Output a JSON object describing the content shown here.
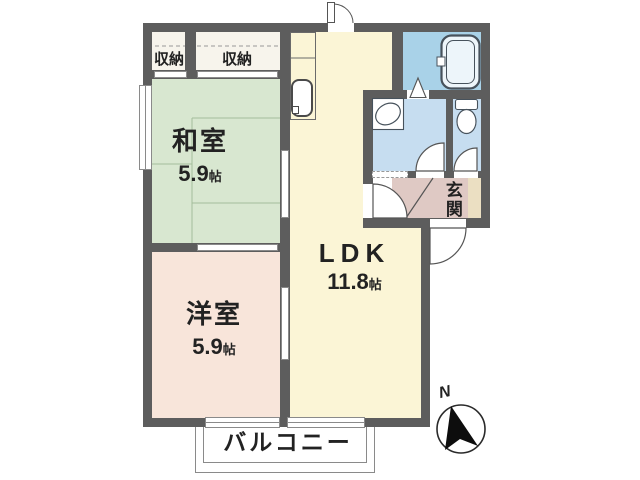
{
  "floor_plan": {
    "rooms": {
      "closet_left": {
        "label": "収納"
      },
      "closet_right": {
        "label": "収納"
      },
      "japanese_room": {
        "label": "和室",
        "area": "5.9",
        "unit": "帖"
      },
      "western_room": {
        "label": "洋室",
        "area": "5.9",
        "unit": "帖"
      },
      "ldk": {
        "label": "LDK",
        "area": "11.8",
        "unit": "帖"
      },
      "entrance": {
        "label": "玄関"
      },
      "balcony": {
        "label": "バルコニー"
      }
    },
    "compass": {
      "north": "N"
    },
    "fixtures": [
      "bathtub-icon",
      "washbasin-icon",
      "toilet-icon",
      "kitchen-sink-icon",
      "north-arrow-icon"
    ],
    "colors": {
      "wall": "#5d5d5d",
      "japanese_room": "#d8e7d0",
      "western_room": "#f8e5da",
      "ldk": "#fbf5d6",
      "bathroom": "#a9d2e8",
      "washroom": "#c6ddf0",
      "toilet": "#c6ddf0",
      "entrance": "#dfc9c4",
      "shoe_cabinet": "#ebdfc2",
      "closet": "#f7f4ec"
    }
  }
}
